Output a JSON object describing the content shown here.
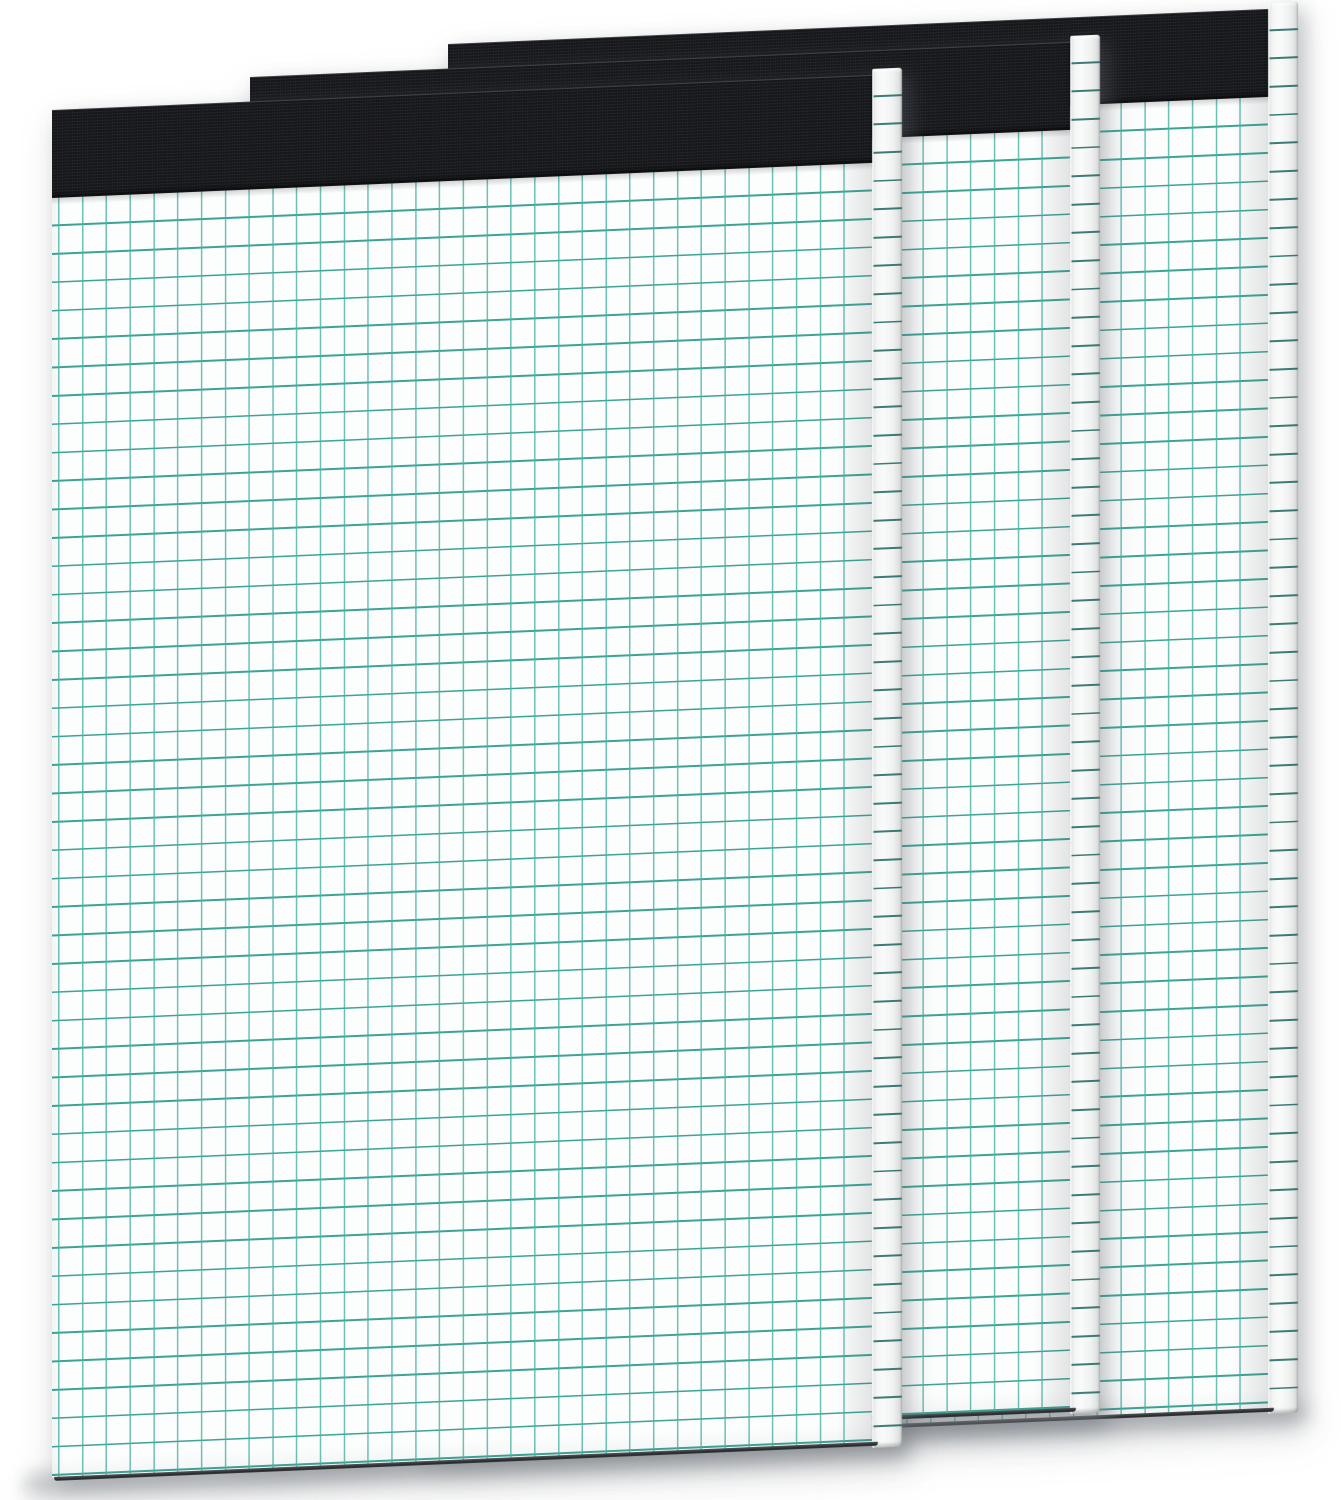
{
  "scene": {
    "type": "product-photo",
    "subject": "Three quad-ruled graph paper notepads with black fabric top binding, fanned on a white background",
    "background_color": "#ffffff",
    "notepad_count": 3
  },
  "notepad": {
    "binding_color": "#141519",
    "paper_color": "#fcfdfd",
    "grid_h_line_color": "rgba(38,154,138,0.9)",
    "grid_v_line_color": "rgba(72,178,164,0.8)",
    "spine_line_color": "rgba(8,90,78,0.78)",
    "binding_height_px": 88,
    "cell_width_px": 23.8,
    "cell_height_px": 28.4,
    "spine_width_px": 30,
    "tilt_deg": -2.45
  },
  "pads": [
    {
      "name": "back",
      "left": 448,
      "top": 44,
      "height": 1400
    },
    {
      "name": "middle",
      "left": 250,
      "top": 77,
      "height": 1367
    },
    {
      "name": "front",
      "left": 52,
      "top": 110,
      "height": 1368
    }
  ]
}
